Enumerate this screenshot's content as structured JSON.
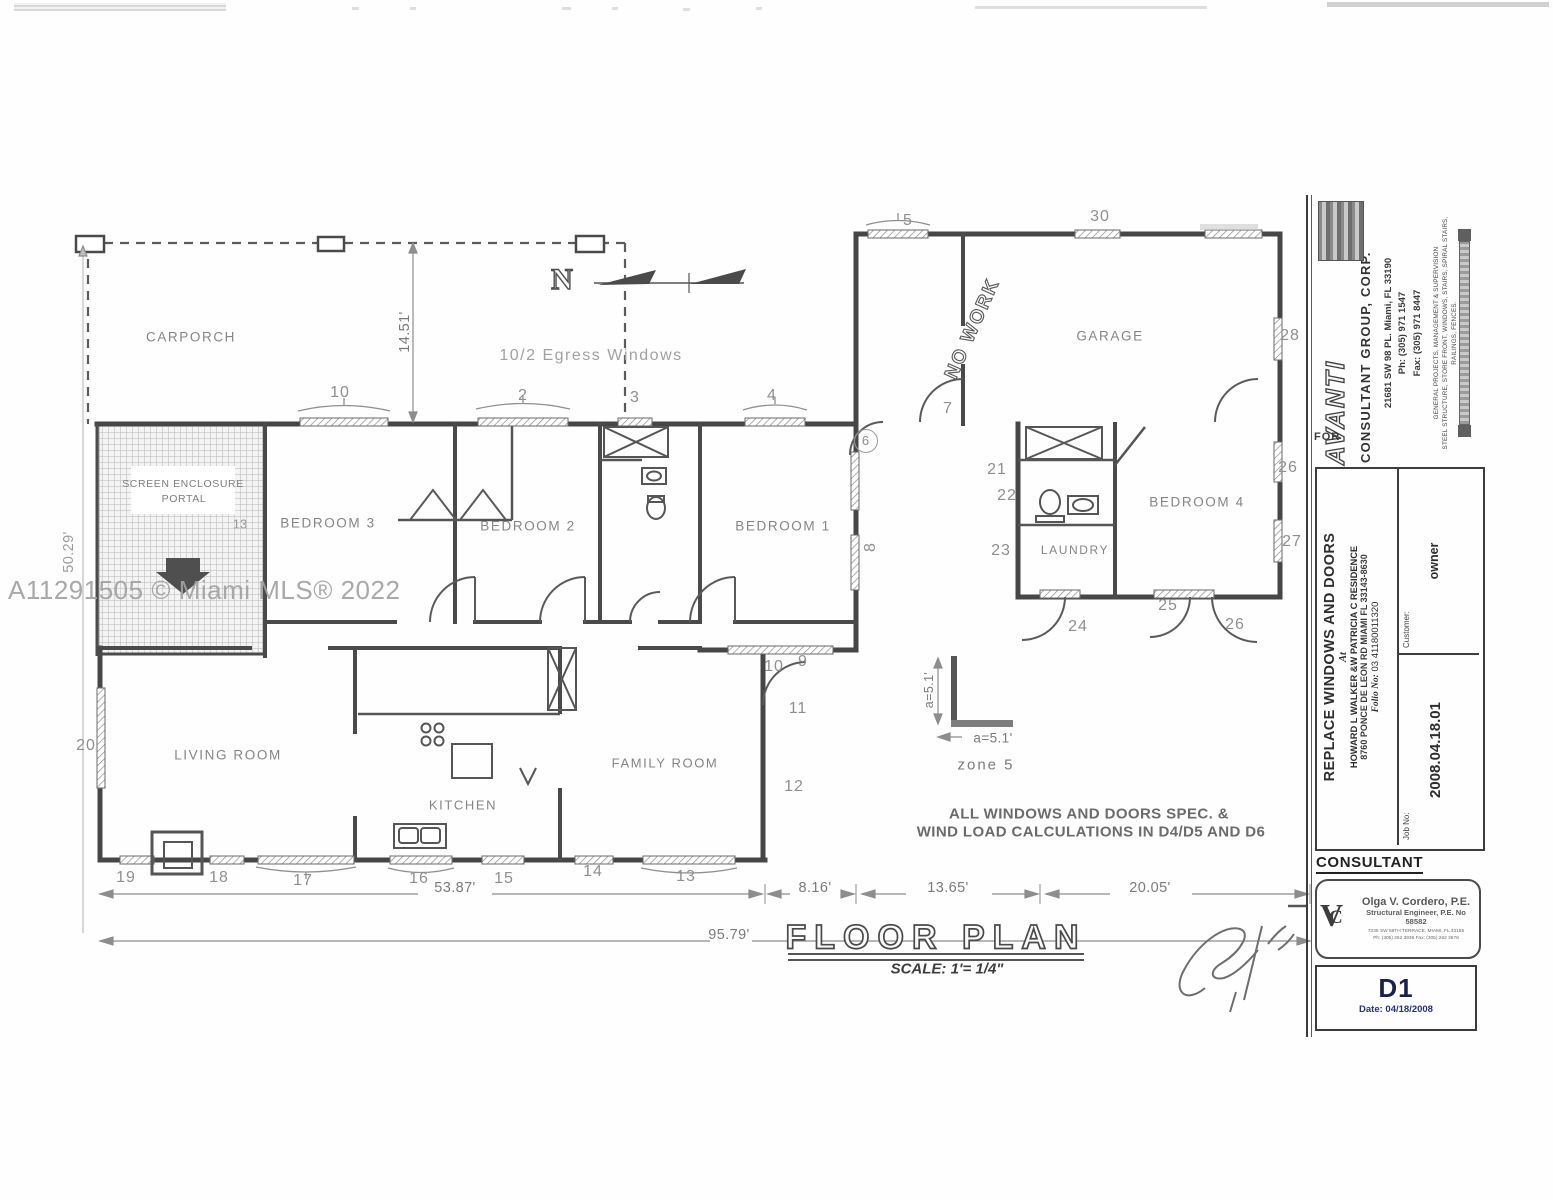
{
  "watermark": "A11291505 © Miami MLS® 2022",
  "colors": {
    "ink": "#4a4a4a",
    "faded_ink": "#8f8f8f",
    "sheet_accent": "#24317c"
  },
  "plan": {
    "north": "N",
    "egress_note": "10/2 Egress Windows",
    "no_work": "NO WORK",
    "title": "FLOOR PLAN",
    "scale": "SCALE: 1'= 1/4\"",
    "spec_line1": "ALL WINDOWS AND DOORS SPEC. &",
    "spec_line2": "WIND LOAD CALCULATIONS IN D4/D5 AND D6",
    "rooms": {
      "carporch": "CARPORCH",
      "screen1": "SCREEN ENCLOSURE",
      "screen2": "PORTAL",
      "bedroom3": "BEDROOM 3",
      "bedroom2": "BEDROOM 2",
      "bedroom1": "BEDROOM 1",
      "bedroom4": "BEDROOM 4",
      "garage": "GARAGE",
      "laundry": "LAUNDRY",
      "living": "LIVING ROOM",
      "kitchen": "KITCHEN",
      "family": "FAMILY ROOM"
    },
    "dims": {
      "carporch_depth": "14.51'",
      "left_height": "50.29'",
      "main_width": "53.87'",
      "total_width": "95.79'",
      "seg1": "8.16'",
      "seg2": "13.65'",
      "seg3": "20.05'"
    },
    "zone": {
      "a_vertical": "a=5.1'",
      "a_horizontal": "a=5.1'",
      "label": "zone 5"
    },
    "markers": {
      "m2": "2",
      "m3": "3",
      "m4": "4",
      "m5": "5",
      "m6": "6",
      "m7": "7",
      "m8": "8",
      "m9": "9",
      "m10_top": "10",
      "m10_wall": "10",
      "m11": "11",
      "m12": "12",
      "m13": "13",
      "m13_screen": "13",
      "m14": "14",
      "m15": "15",
      "m16": "16",
      "m17": "17",
      "m18": "18",
      "m19": "19",
      "m20": "20",
      "m21": "21",
      "m22": "22",
      "m23": "23",
      "m24": "24",
      "m25": "25",
      "m26_right": "26",
      "m26_bottom": "26",
      "m27": "27",
      "m28": "28",
      "m30": "30"
    }
  },
  "titleblock": {
    "for_label": "FOR",
    "brand": "AVANTI",
    "brand_sub": "CONSULTANT GROUP, CORP.",
    "address": "21681 SW 98 PL. Miami, FL 33190",
    "phone": "Ph:  (305) 971 1547",
    "fax": "Fax: (305) 971 8447",
    "services1": "GENERAL  PROJECTS,  MANAGEMENT  &  SUPERVISION",
    "services2": "STEEL STRUCTURE, STORE FRONT, WINDOWS, STAIRS, SPIRAL STAIRS, RAILINGS, FENCES.",
    "project_title": "REPLACE WINDOWS AND DOORS",
    "at_label": "At",
    "owner_line1": "HOWARD L WALKER &W PATRICIA C  RESIDENCE",
    "owner_line2": "8760 PONCE DE LEON RD MIAMI FL  33143-8630",
    "folio_label": "Folio No:",
    "folio_value": "03  41180011320",
    "customer_label": "Customer:",
    "customer_value": "owner",
    "job_label": "Job No:",
    "job_value": "2008.04.18.01",
    "consultant_heading": "CONSULTANT",
    "stamp": {
      "monogram_v": "V",
      "monogram_c": "C",
      "name": "Olga V. Cordero, P.E.",
      "title": "Structural Engineer, P.E. No 58582",
      "address": "7235 SW 58TH TERRACE, MIAMI, FL 33155",
      "phone": "Ph: (305) 262 3936  Fax: (305) 262 3678"
    },
    "sheet": {
      "number": "D1",
      "date": "Date: 04/18/2008"
    }
  }
}
